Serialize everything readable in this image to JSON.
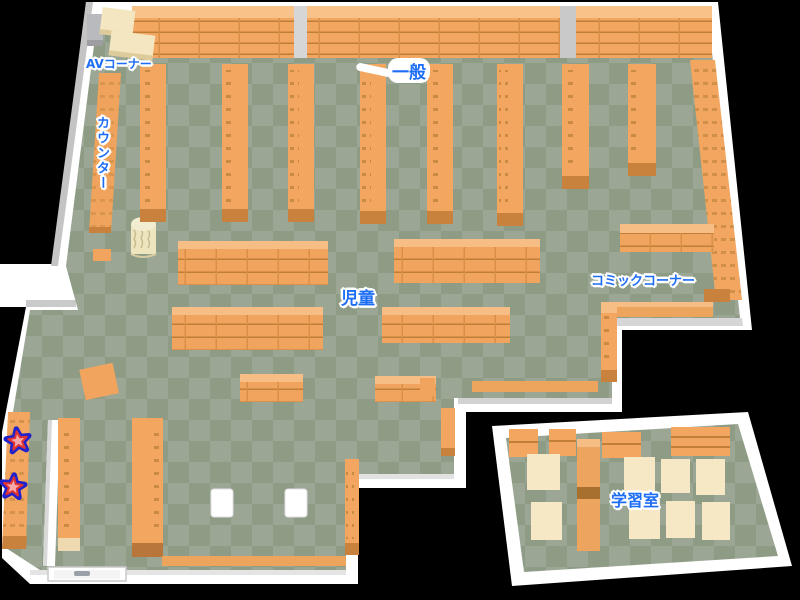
{
  "map": {
    "type": "library-floor-map",
    "sections": {
      "av_corner": {
        "label": "AVコーナー"
      },
      "counter": {
        "label": "カウンター"
      },
      "general": {
        "label": "一般"
      },
      "children": {
        "label": "児童"
      },
      "comic_corner": {
        "label": "コミックコーナー"
      },
      "study_room": {
        "label": "学習室"
      }
    },
    "markers": {
      "stars": [
        {
          "name": "star-marker-1",
          "x": 18,
          "y": 441
        },
        {
          "name": "star-marker-2",
          "x": 13,
          "y": 487
        }
      ]
    },
    "colors": {
      "background": "#000000",
      "wall": "#FFFFFF",
      "wall_shade": "#C9C9C9",
      "floor_light": "#9BA794",
      "floor_dark": "#8F9C85",
      "shelf_orange": "#F2A660",
      "shelf_top": "#F8C289",
      "shelf_shadow": "#C8823E",
      "accent_cream": "#F3E6C0",
      "table_cream": "#F6E8C4",
      "label_blue": "#1E6EF5",
      "star_pink": "#F8A8A8",
      "star_red": "#E23333",
      "star_blue": "#2222CC"
    }
  }
}
